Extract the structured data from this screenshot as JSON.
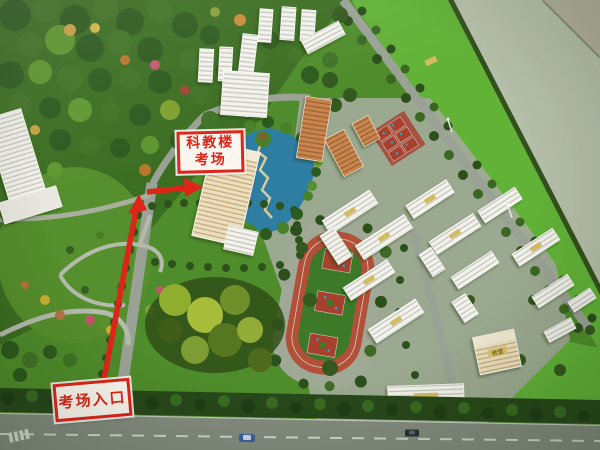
{
  "annotations": {
    "building_label": {
      "line1": "科教楼",
      "line2": "考场"
    },
    "entrance_label": {
      "text": "考场入口"
    }
  },
  "model_labels": {
    "canteen_plate": "食堂"
  },
  "colors": {
    "annotation_red": "#de2518",
    "label_background": "#fbf7f0",
    "lake_blue": "#2e7da3",
    "lawn_green": "#62b238",
    "grass_green": "#4f8c2b",
    "forest_green": "#3a6a21",
    "track_red": "#b2503a",
    "court_red": "#a8402e",
    "road_gray": "#9aa295",
    "floor_gray": "#b6bfaa",
    "building_white": "#f3f2ec",
    "building_cream": "#ecdfc0",
    "building_orange": "#c8854e"
  }
}
